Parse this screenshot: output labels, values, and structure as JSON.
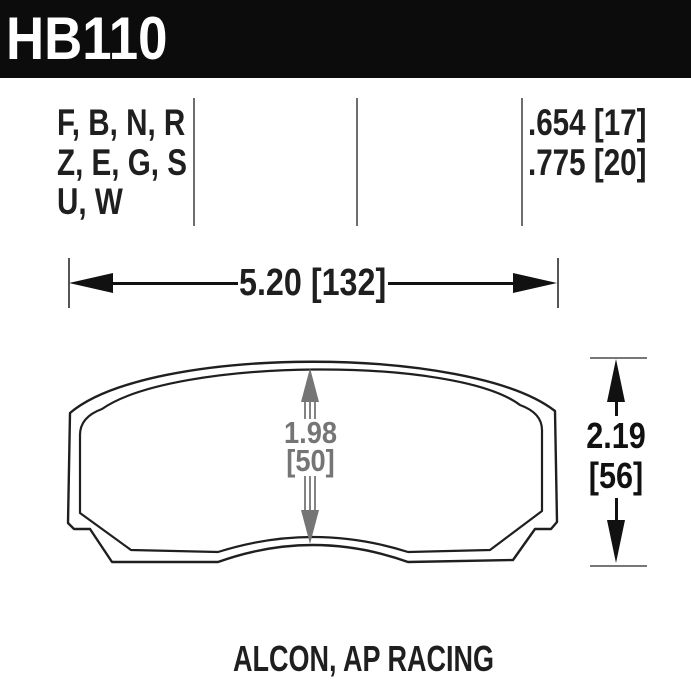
{
  "header": {
    "part_number": "HB110",
    "bar_color": "#0c0c0c",
    "text_color": "#ffffff"
  },
  "spec_row": {
    "compound_lines": [
      "F, B, N, R",
      "Z, E, G, S",
      "U, W"
    ],
    "thickness_lines": [
      ".654 [17]",
      ".775 [20]"
    ]
  },
  "dimensions": {
    "pad_width": {
      "label": "5.20 [132]"
    },
    "friction_height": {
      "line1": "1.98",
      "line2": "[50]"
    },
    "overall_height": {
      "line1": "2.19",
      "line2": "[56]"
    }
  },
  "footer": {
    "applications": "ALCON, AP RACING"
  },
  "colors": {
    "line_work": "#1f1f1f",
    "dim_gray": "#757575",
    "divider_gray": "#6e6e6e",
    "background": "#ffffff"
  }
}
